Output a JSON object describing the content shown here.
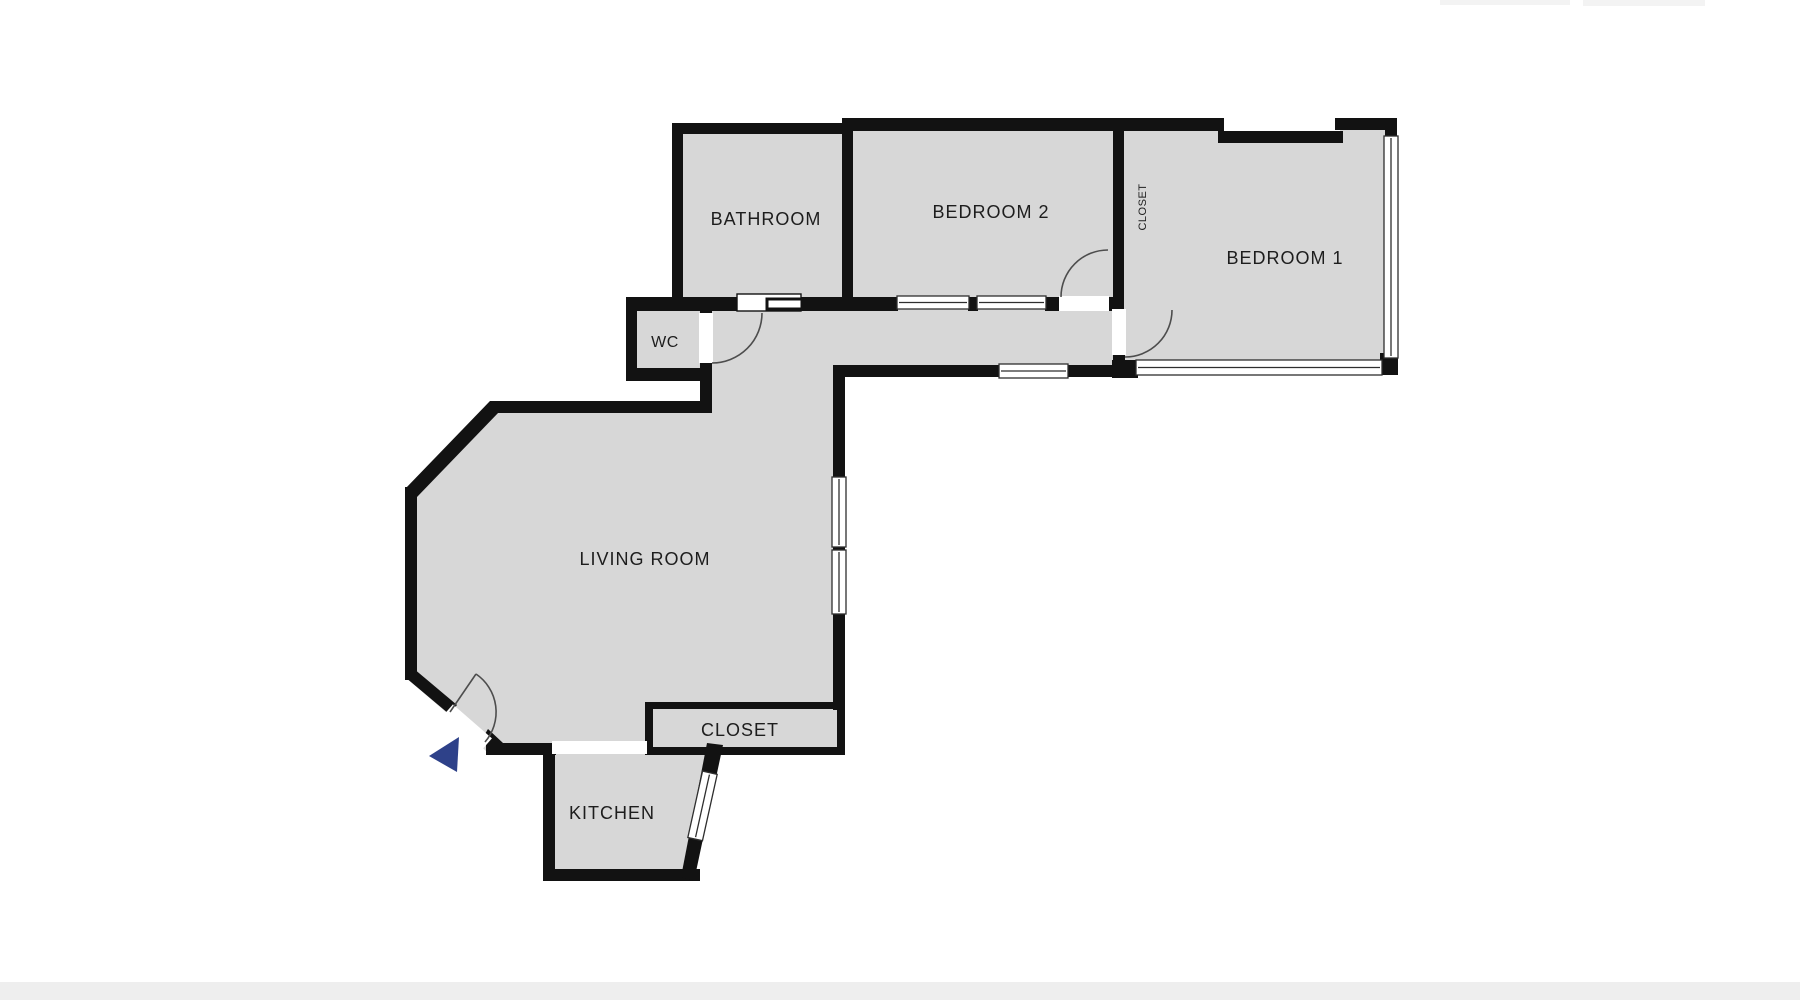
{
  "plan": {
    "rooms": {
      "bathroom": {
        "label": "BATHROOM"
      },
      "bedroom2": {
        "label": "BEDROOM 2"
      },
      "closet_top": {
        "label": "CLOSET"
      },
      "bedroom1": {
        "label": "BEDROOM 1"
      },
      "wc": {
        "label": "WC"
      },
      "living": {
        "label": "LIVING ROOM"
      },
      "closet": {
        "label": "CLOSET"
      },
      "kitchen": {
        "label": "KITCHEN"
      }
    },
    "icons": {
      "entry_arrow": "triangle-left-entry-direction"
    }
  },
  "colors": {
    "room_fill": "#d7d7d7",
    "wall": "#121212",
    "opening": "#ffffff",
    "window_line": "#2e2e2e",
    "door_arc": "#4d4d4d",
    "label": "#1d1d1d",
    "entry_arrow": "#2e4189",
    "bottom_bar": "#eeeeee",
    "faint_bar": "#f3f3f3"
  }
}
